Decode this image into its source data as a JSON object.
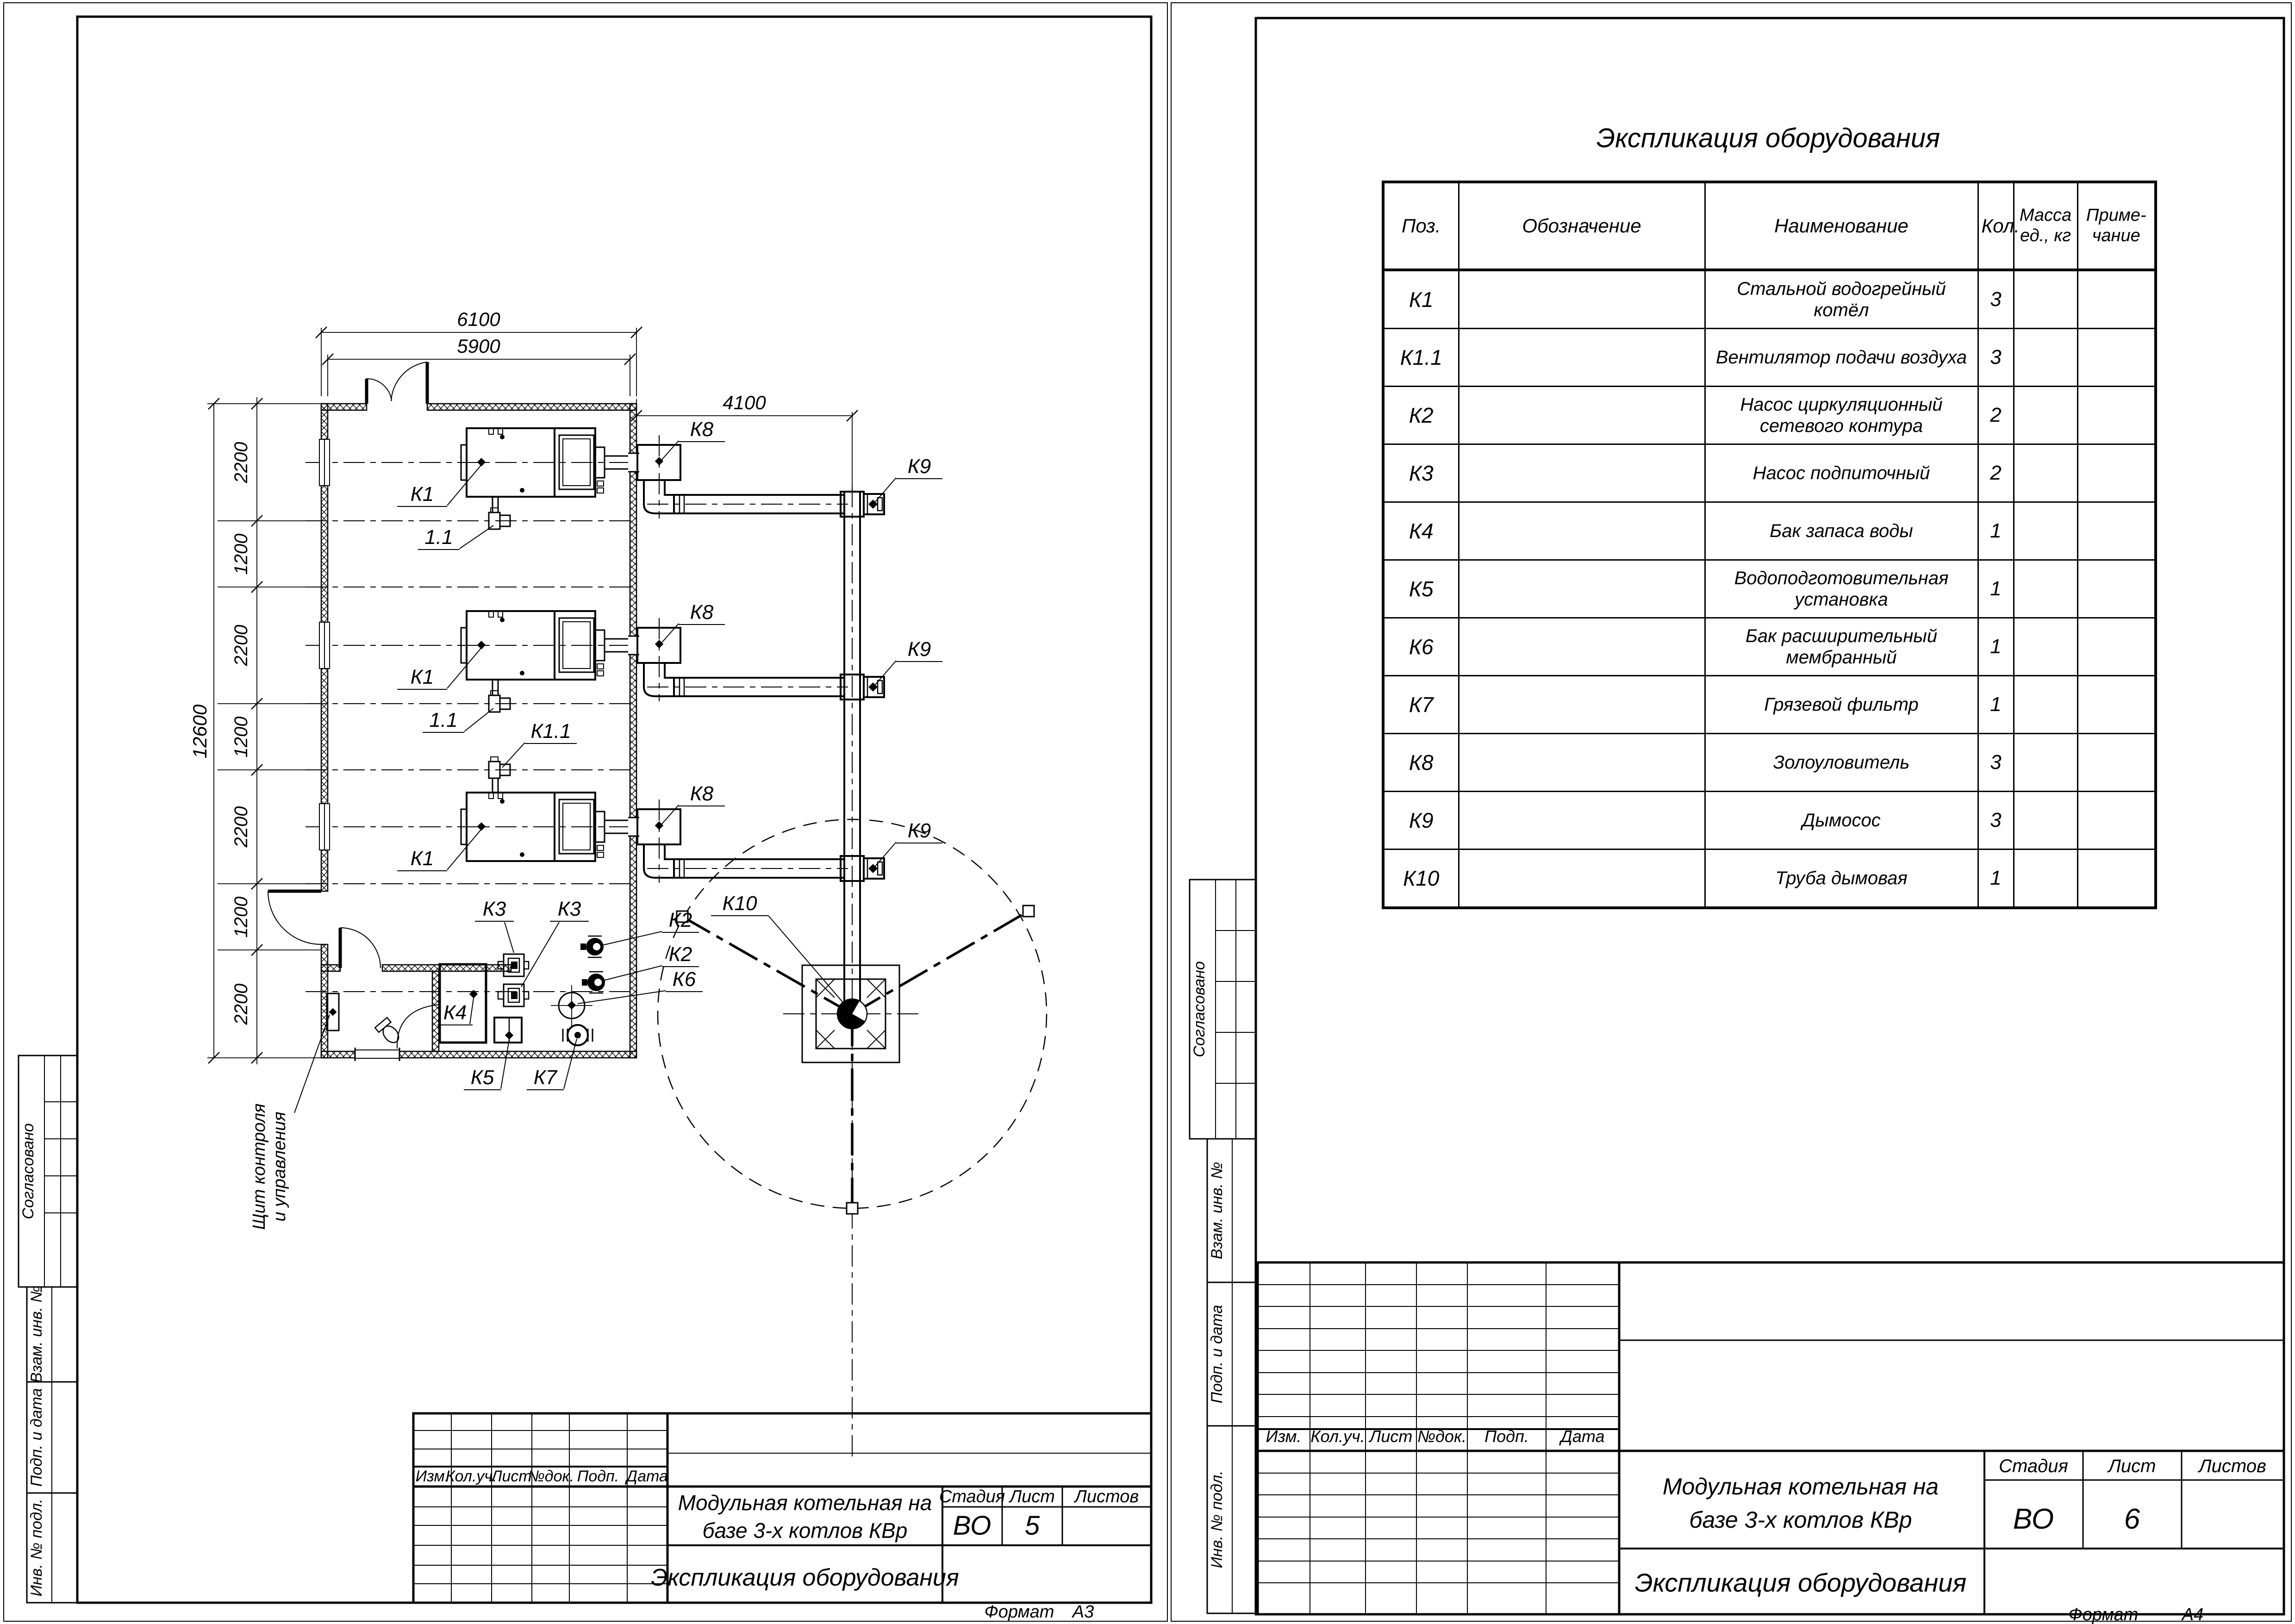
{
  "common": {
    "rev_cols": [
      "Изм.",
      "Кол.уч.",
      "Лист",
      "№док.",
      "Подп.",
      "Дата"
    ],
    "side_stamps": [
      "Согласовано",
      "Взам. инв. №",
      "Подп. и дата",
      "Инв. № подл."
    ],
    "project_title_l1": "Модульная котельная на",
    "project_title_l2": "базе 3-х котлов КВр",
    "doc_title": "Экспликация оборудования",
    "stage_label": "Стадия",
    "sheet_label": "Лист",
    "sheets_label": "Листов",
    "format_label": "Формат"
  },
  "left_sheet": {
    "stage": "ВО",
    "sheet_num": "5",
    "format": "А3"
  },
  "right_sheet": {
    "table_title": "Экспликация оборудования",
    "stage": "ВО",
    "sheet_num": "6",
    "format": "А4",
    "table": {
      "headers": {
        "pos": "Поз.",
        "designation": "Обозначение",
        "name": "Наименование",
        "qty": "Кол.",
        "mass_l1": "Масса",
        "mass_l2": "ед., кг",
        "note_l1": "Приме-",
        "note_l2": "чание"
      },
      "rows": [
        {
          "pos": "К1",
          "name": "Стальной водогрейный котёл",
          "qty": "3"
        },
        {
          "pos": "К1.1",
          "name": "Вентилятор подачи воздуха",
          "qty": "3"
        },
        {
          "pos": "К2",
          "name": "Насос циркуляционный сетевого контура",
          "qty": "2"
        },
        {
          "pos": "К3",
          "name": "Насос подпиточный",
          "qty": "2"
        },
        {
          "pos": "К4",
          "name": "Бак запаса воды",
          "qty": "1"
        },
        {
          "pos": "К5",
          "name": "Водоподготовительная установка",
          "qty": "1"
        },
        {
          "pos": "К6",
          "name": "Бак расширительный мембранный",
          "qty": "1"
        },
        {
          "pos": "К7",
          "name": "Грязевой фильтр",
          "qty": "1"
        },
        {
          "pos": "К8",
          "name": "Золоуловитель",
          "qty": "3"
        },
        {
          "pos": "К9",
          "name": "Дымосос",
          "qty": "3"
        },
        {
          "pos": "К10",
          "name": "Труба дымовая",
          "qty": "1"
        }
      ]
    }
  },
  "plan": {
    "dims": {
      "w_outer": "6100",
      "w_inner": "5900",
      "flue": "4100",
      "total": "12600",
      "segments": [
        "2200",
        "1200",
        "2200",
        "1200",
        "2200",
        "1200",
        "2200"
      ]
    },
    "labels": {
      "boiler": "К1",
      "boiler_fan": "1.1",
      "boiler_fan_k": "К1.1",
      "ash_catcher": "К8",
      "smoke_exhauster": "К9",
      "chimney": "К10",
      "pump_network": "К2",
      "pump_makeup": "К3",
      "water_tank": "К4",
      "water_treatment": "К5",
      "expansion_tank": "К6",
      "mud_filter": "К7",
      "control_panel_l1": "Щит контроля",
      "control_panel_l2": "и управления"
    }
  }
}
